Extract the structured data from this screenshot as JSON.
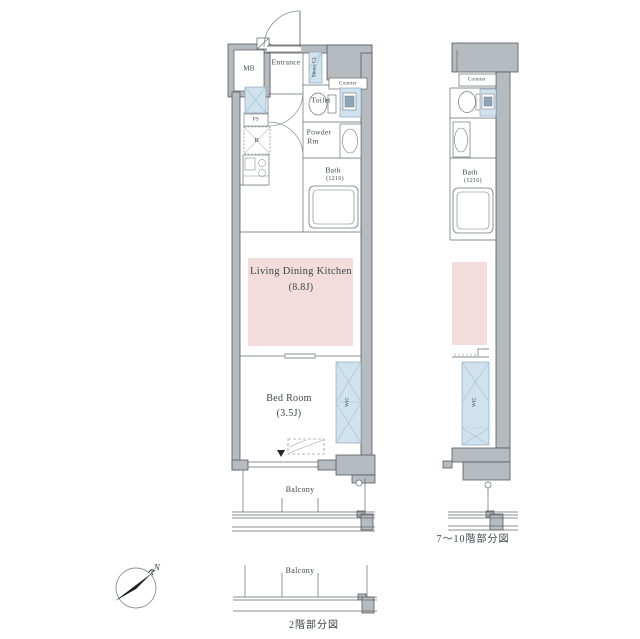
{
  "colors": {
    "wall_fill": "#b6bbc0",
    "wall_stroke": "#565b61",
    "line": "#63686e",
    "ldk_fill": "#f3dddc",
    "closet_fill": "#cfe2ee",
    "text": "#3f444a"
  },
  "compass": {
    "north_label": "N"
  },
  "plan_main": {
    "caption": "2階部分図",
    "rooms": {
      "mb": "MB",
      "entrance": "Entrance",
      "shoes_closet": "Shoes Cl.",
      "counter": "Counter",
      "toilet": "Toilet",
      "powder_line1": "Powder",
      "powder_line2": "Rm",
      "bath": "Bath",
      "bath_size": "(1216)",
      "pipe_space": "PS",
      "refrigerator": "R",
      "ldk_line1": "Living Dining Kitchen",
      "ldk_line2": "(8.8J)",
      "bedroom_line1": "Bed Room",
      "bedroom_line2": "(3.5J)",
      "wic": "WIC",
      "balcony": "Balcony"
    },
    "lower_balcony_label": "Balcony"
  },
  "plan_upper": {
    "caption": "7〜10階部分図",
    "rooms": {
      "counter": "Counter",
      "bath": "Bath",
      "bath_size": "(1216)",
      "wic": "WIC"
    }
  }
}
